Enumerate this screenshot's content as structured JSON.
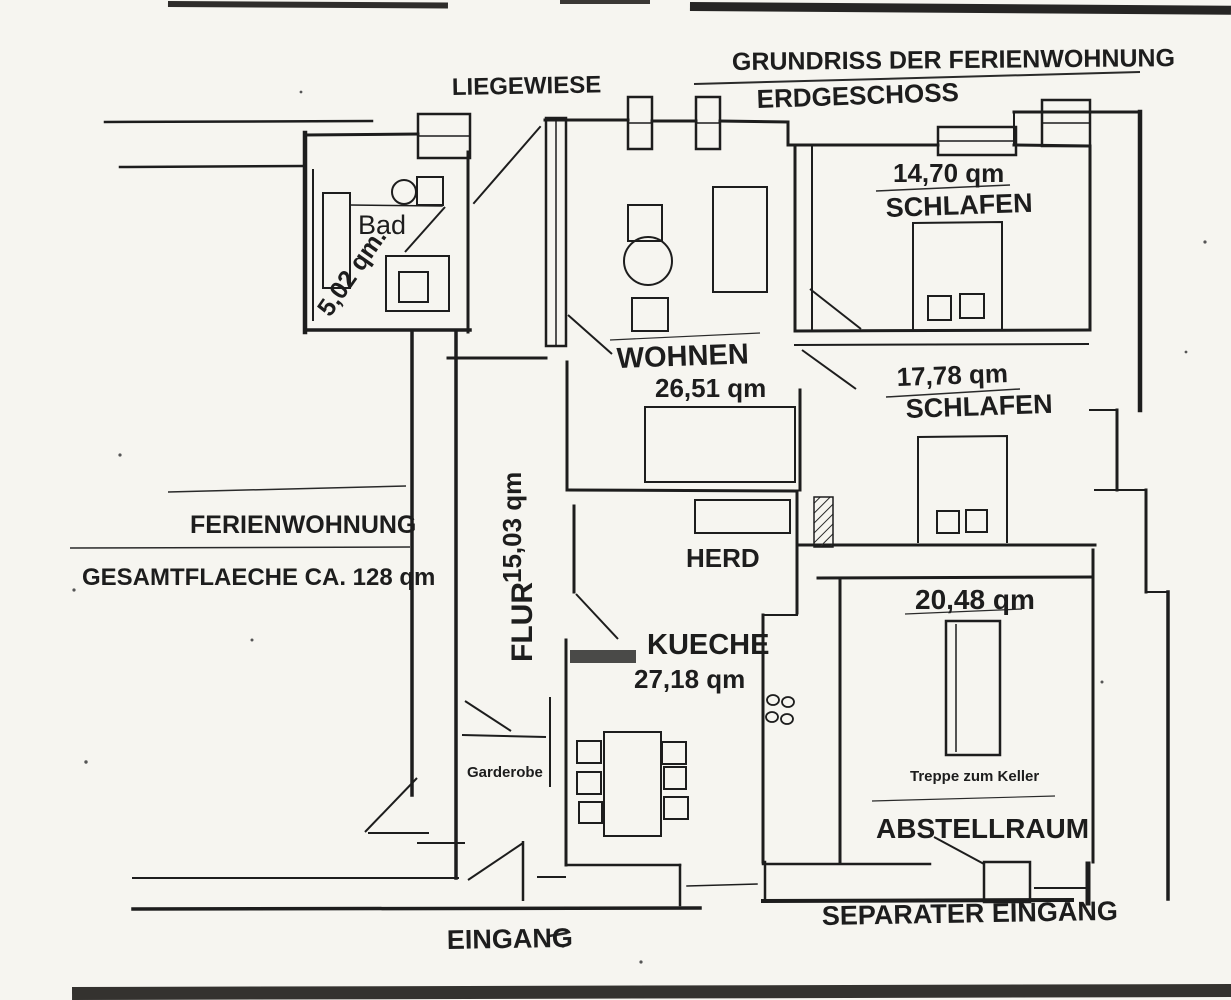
{
  "document": {
    "title": "GRUNDRISS DER FERIENWOHNUNG",
    "subtitle": "ERDGESCHOSS"
  },
  "summary": {
    "property_label": "FERIENWOHNUNG",
    "total_area_label": "GESAMTFLAECHE CA. 128 qm"
  },
  "outdoor": {
    "lawn_label": "LIEGEWIESE"
  },
  "rooms": [
    {
      "id": "bad",
      "name": "Bad",
      "area": "5,02 qm."
    },
    {
      "id": "schlafen-1",
      "name": "SCHLAFEN",
      "area": "14,70 qm"
    },
    {
      "id": "wohnen",
      "name": "WOHNEN",
      "area": "26,51 qm"
    },
    {
      "id": "schlafen-2",
      "name": "SCHLAFEN",
      "area": "17,78 qm"
    },
    {
      "id": "flur",
      "name": "FLUR",
      "area": "15,03 qm"
    },
    {
      "id": "kueche",
      "name": "KUECHE",
      "area": "27,18 qm"
    },
    {
      "id": "abstellraum",
      "name": "ABSTELLRAUM",
      "area": "20,48 qm"
    }
  ],
  "features": {
    "herd_label": "HERD",
    "garderobe_label": "Garderobe",
    "treppe_label": "Treppe zum Keller"
  },
  "entrances": {
    "main": "EINGANG",
    "separate": "SEPARATER EINGANG"
  },
  "colors": {
    "ink": "#1d1d1d",
    "paper": "#f6f5f0"
  }
}
